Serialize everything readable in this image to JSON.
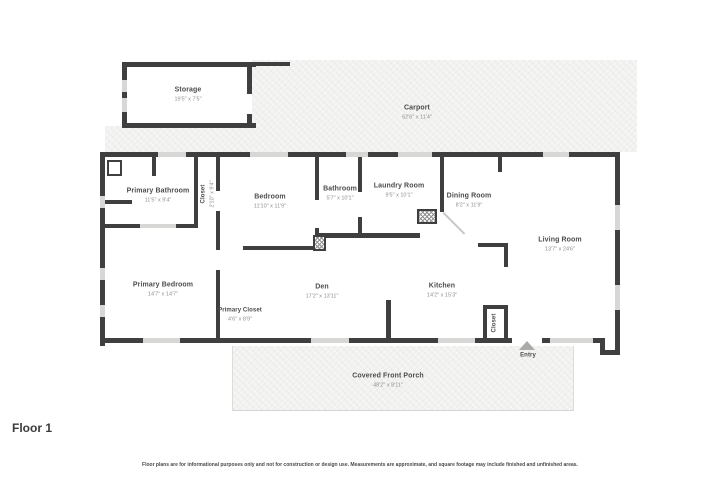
{
  "floor_label": "Floor 1",
  "disclaimer": "Floor plans are for informational purposes only and not for construction or design use. Measurements are approximate, and square footage may include finished and unfinished areas.",
  "colors": {
    "wall": "#3f3f3f",
    "window": "#d7d7d5",
    "paved_area": "#f5f5f3",
    "room_name_text": "#4c4c4c",
    "dimension_text": "#8f8f8f",
    "entry_arrow": "#ababab"
  },
  "icons": {
    "entry_arrow": "triangle-up-icon"
  },
  "rooms": [
    {
      "name": "Storage",
      "dims": "19'5\" x 7'5\""
    },
    {
      "name": "Carport",
      "dims": "62'6\" x 11'4\""
    },
    {
      "name": "Primary Bathroom",
      "dims": "11'5\" x 9'4\""
    },
    {
      "name": "Closet",
      "dims": "2'10\" x 9'4\""
    },
    {
      "name": "Bedroom",
      "dims": "11'10\" x 11'9\""
    },
    {
      "name": "Bathroom",
      "dims": "5'7\" x 10'1\""
    },
    {
      "name": "Laundry Room",
      "dims": "9'5\" x 10'1\""
    },
    {
      "name": "Dining Room",
      "dims": "8'2\" x 11'9\""
    },
    {
      "name": "Living Room",
      "dims": "13'7\" x 24'6\""
    },
    {
      "name": "Primary Bedroom",
      "dims": "14'7\" x 14'7\""
    },
    {
      "name": "Primary Closet",
      "dims": "4'6\" x 8'9\""
    },
    {
      "name": "Den",
      "dims": "17'2\" x 13'11\""
    },
    {
      "name": "Kitchen",
      "dims": "14'2\" x 15'3\""
    },
    {
      "name": "Closet",
      "dims": ""
    },
    {
      "name": "Entry",
      "dims": ""
    },
    {
      "name": "Covered Front Porch",
      "dims": "48'2\" x 8'11\""
    }
  ]
}
